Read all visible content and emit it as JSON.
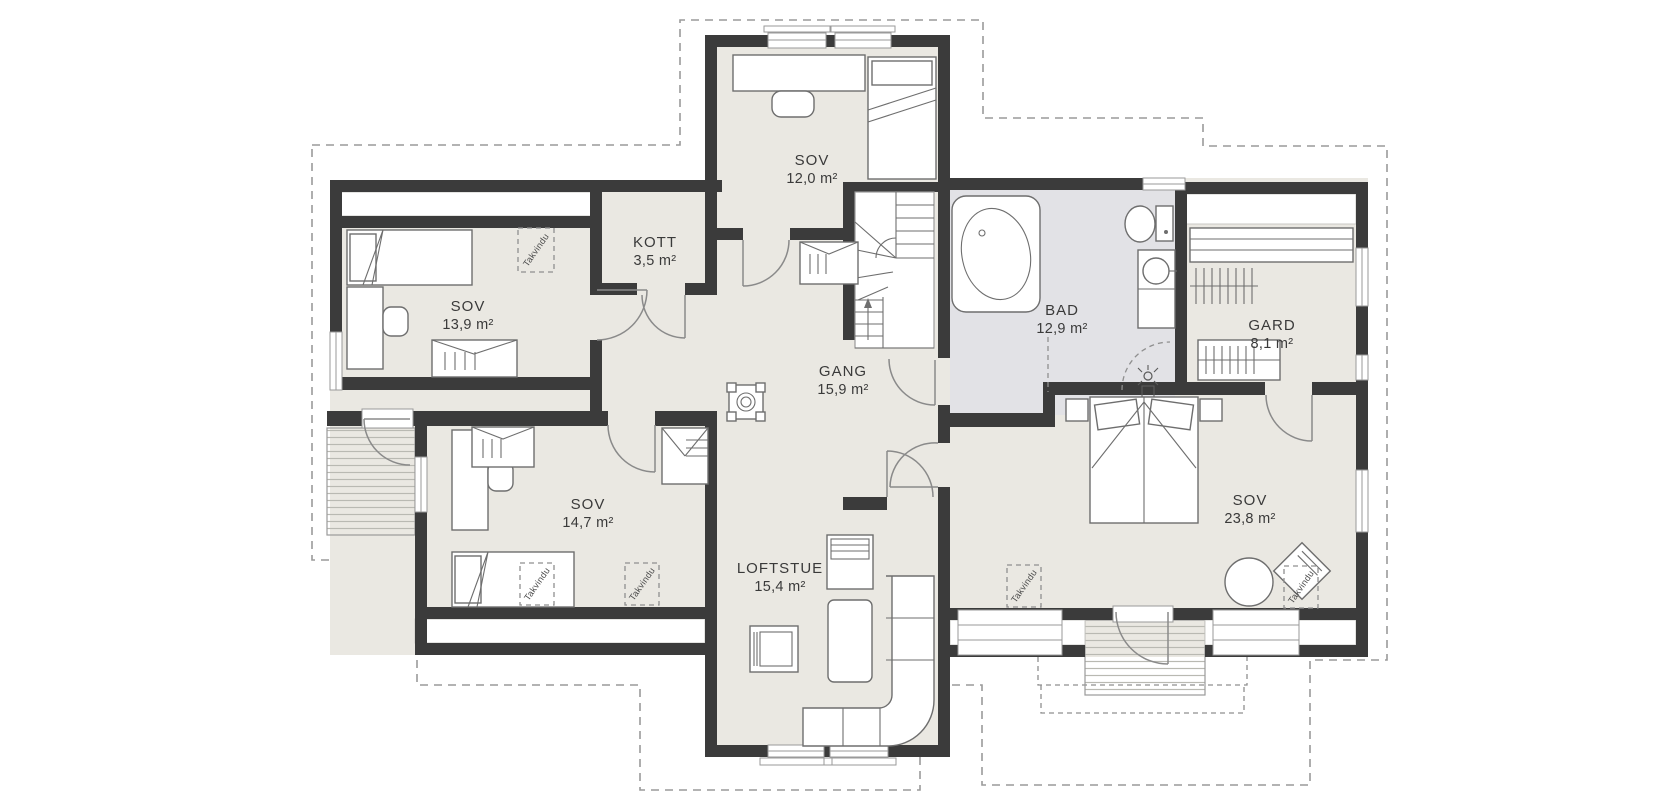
{
  "plan": {
    "takvindu_label": "Takvindu",
    "rooms": [
      {
        "id": "sov-139",
        "name": "SOV",
        "area": "13,9 m²"
      },
      {
        "id": "kott",
        "name": "KOTT",
        "area": "3,5 m²"
      },
      {
        "id": "sov-120",
        "name": "SOV",
        "area": "12,0 m²"
      },
      {
        "id": "gang",
        "name": "GANG",
        "area": "15,9 m²"
      },
      {
        "id": "bad",
        "name": "BAD",
        "area": "12,9 m²"
      },
      {
        "id": "gard",
        "name": "GARD",
        "area": "8,1 m²"
      },
      {
        "id": "sov-147",
        "name": "SOV",
        "area": "14,7 m²"
      },
      {
        "id": "loftstue",
        "name": "LOFTSTUE",
        "area": "15,4 m²"
      },
      {
        "id": "sov-238",
        "name": "SOV",
        "area": "23,8 m²"
      }
    ],
    "colors": {
      "floor": "#eae8e2",
      "bathroom_floor": "#e2e2e6",
      "wall": "#3b3b3b",
      "outline": "#8f8f8f",
      "dashed": "#9a9a9a",
      "text": "#3a3a3a"
    }
  }
}
